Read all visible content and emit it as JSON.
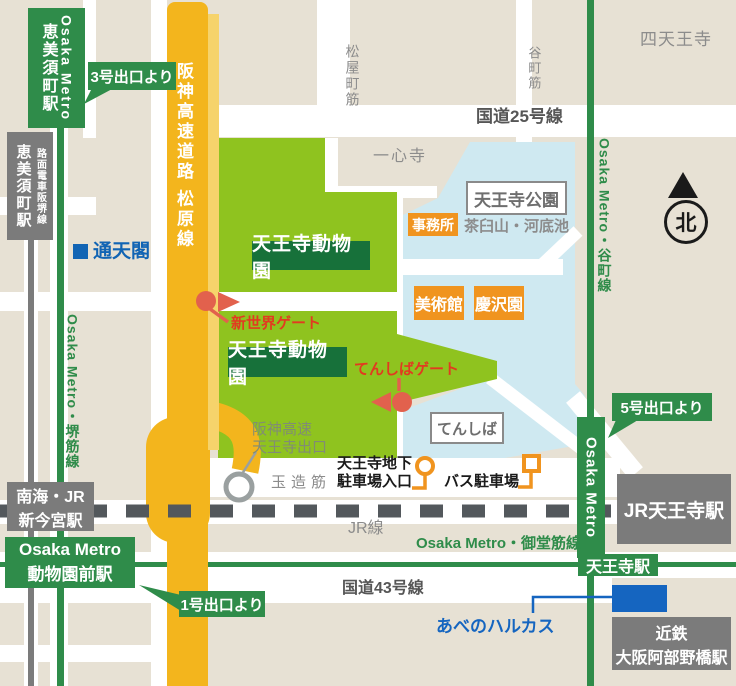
{
  "colors": {
    "background_beige": "#e7e1d4",
    "road_white": "#ffffff",
    "expressway_yellow": "#f3b51d",
    "expressway_shadow": "#f6d36b",
    "zoo_green": "#8fc31f",
    "zoo_label_green": "#17713a",
    "metro_green": "#2f8c4a",
    "park_blue": "#cfe9f1",
    "facility_orange": "#f0941f",
    "gate_pin_red": "#e2614d",
    "gate_text_red": "#e23a20",
    "station_gray": "#7b7b7b",
    "jr_dash_gray": "#53585c",
    "label_gray": "#8c8c8c",
    "dark_text": "#1a1a1a",
    "landmark_blue": "#1565c0",
    "road_text_gray": "#565656",
    "exit_text_gray": "#818c74"
  },
  "stations": {
    "ebisucho_metro": {
      "operator": "Osaka Metro",
      "name": "恵美須町駅"
    },
    "ebisucho_tram": {
      "line": "路面電車阪堺線",
      "name": "恵美須町駅"
    },
    "shin_imamiya": {
      "operator": "南海・JR",
      "name": "新今宮駅"
    },
    "dobutsuen_mae": {
      "operator": "Osaka Metro",
      "name": "動物園前駅"
    },
    "tennoji_metro": {
      "name": "天王寺駅"
    },
    "tennoji_metro_bar": {
      "label": "Osaka Metro"
    },
    "jr_tennoji": {
      "name": "JR天王寺駅"
    },
    "kintetsu_abenobashi": {
      "operator": "近鉄",
      "name": "大阪阿部野橋駅"
    }
  },
  "exit_notes": {
    "exit3": "3号出口より",
    "exit5": "5号出口より",
    "exit1": "1号出口より"
  },
  "zoo": {
    "label1": "天王寺動物園",
    "label2": "天王寺動物園"
  },
  "gates": {
    "shinsekai": "新世界ゲート",
    "tenshiba": "てんしばゲート"
  },
  "park": {
    "name": "天王寺公園",
    "hill_pond": "茶臼山・河底池",
    "office": "事務所",
    "museum": "美術館",
    "garden": "慶沢園",
    "tenshiba": "てんしば"
  },
  "roads": {
    "expressway": "阪神高速道路 松原線",
    "expressway_exit_line1": "阪神高速",
    "expressway_exit_line2": "天王寺出口",
    "route25": "国道25号線",
    "route43": "国道43号線",
    "matsuyamachi_suji": "松屋町筋",
    "tanimachi_suji": "谷町筋",
    "tamatsukuri_suji": "玉造筋"
  },
  "railways": {
    "jr_line": "JR線",
    "midosuji_line": "Osaka Metro・御堂筋線",
    "sakaisuji_line": "Osaka Metro・堺筋線",
    "tanimachi_line": "Osaka Metro・谷町線"
  },
  "landmarks": {
    "tsutenkaku": "通天閣",
    "isshinji": "一心寺",
    "shitennoji": "四天王寺",
    "harukas": "あべのハルカス"
  },
  "parking": {
    "underground_line1": "天王寺地下",
    "underground_line2": "駐車場入口",
    "bus": "バス駐車場"
  },
  "compass": {
    "north": "北"
  },
  "icons": {
    "gate_pin": "red-circle-pin",
    "gate_arrow": "red-triangle-arrow",
    "parking_sign": "orange-circle-sign",
    "bus_parking_sign": "orange-square-sign",
    "expressway_exit_marker": "white-circle-marker",
    "north_arrow": "black-triangle",
    "tsutenkaku_marker": "blue-square",
    "harukas_building": "blue-rectangle"
  }
}
